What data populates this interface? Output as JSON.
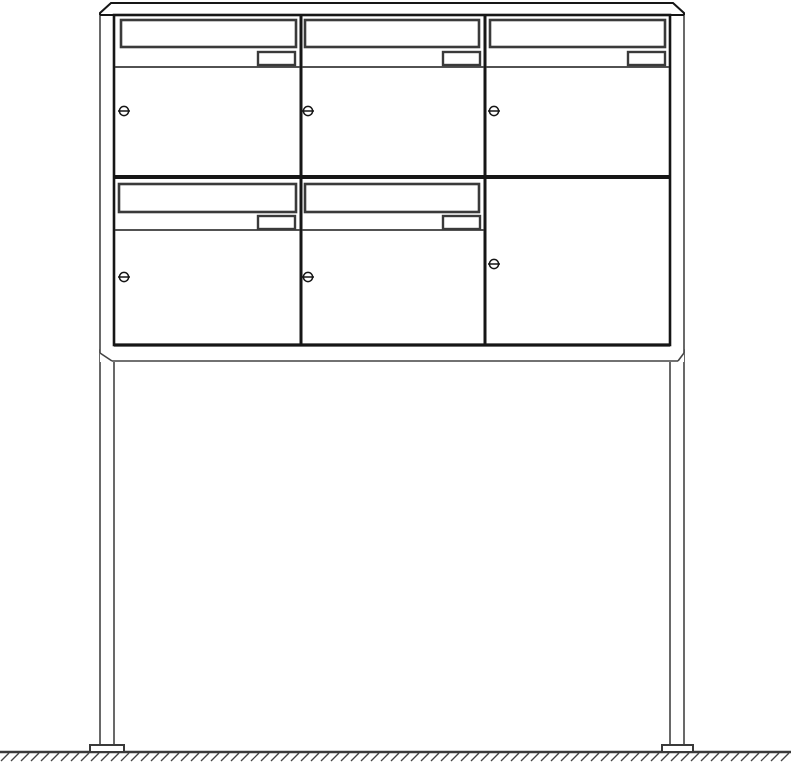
{
  "page": {
    "background": "#ffffff",
    "canvas": {
      "width": 791,
      "height": 762
    }
  },
  "drawing": {
    "kind": "technical-line-drawing",
    "subject": "free-standing-letterbox-unit",
    "colors": {
      "outline": "#161616",
      "detail": "#3a3a3a",
      "thin": "#444444",
      "fill": "#ffffff"
    },
    "unit": {
      "rows": 2,
      "columns": 3,
      "mailboxes_with_slot": 5,
      "plain_locked_doors": 1,
      "legs": 2
    },
    "frame": {
      "roof": {
        "top_y": 3,
        "bottom_y": 15,
        "left_x": 100,
        "right_x": 684,
        "chamfer": 11
      },
      "face": {
        "x": 114,
        "y": 15,
        "w": 556,
        "h": 330
      },
      "column_dividers_x": [
        301,
        485
      ],
      "row_divider_y": 177,
      "base": {
        "line_y": 345,
        "bottom_y": 361,
        "left_x": 100,
        "right_x": 684,
        "chamfer_w": 12,
        "chamfer_h": 8
      },
      "legs": [
        {
          "side": "left",
          "x": 100,
          "w": 14
        },
        {
          "side": "right",
          "x": 670,
          "w": 14
        }
      ],
      "legs_top_y": 350,
      "legs_bottom_y": 746,
      "feet": [
        {
          "side": "left",
          "x": 90,
          "w": 34
        },
        {
          "side": "right",
          "x": 662,
          "w": 31
        }
      ],
      "feet_y": 745,
      "feet_h": 7,
      "ground_y": 752,
      "hatch": {
        "step": 10,
        "dx": 8,
        "y_low": 761,
        "y_high": 753,
        "x_start": 1,
        "x_end": 791
      }
    },
    "compartments": [
      {
        "id": "top-left",
        "row": 0,
        "col": 0,
        "door": {
          "x": 114,
          "y": 15,
          "w": 187,
          "h": 162
        },
        "slot": {
          "x": 121,
          "y": 20,
          "w": 175,
          "h": 27
        },
        "flap_line_y": 67,
        "nameplate": {
          "x": 258,
          "y": 52,
          "w": 37,
          "h": 13
        },
        "lock": {
          "cx": 124,
          "cy": 111
        }
      },
      {
        "id": "top-middle",
        "row": 0,
        "col": 1,
        "door": {
          "x": 301,
          "y": 15,
          "w": 184,
          "h": 162
        },
        "slot": {
          "x": 305,
          "y": 20,
          "w": 174,
          "h": 27
        },
        "flap_line_y": 67,
        "nameplate": {
          "x": 443,
          "y": 52,
          "w": 37,
          "h": 13
        },
        "lock": {
          "cx": 308,
          "cy": 111
        }
      },
      {
        "id": "top-right",
        "row": 0,
        "col": 2,
        "door": {
          "x": 485,
          "y": 15,
          "w": 185,
          "h": 162
        },
        "slot": {
          "x": 490,
          "y": 20,
          "w": 175,
          "h": 27
        },
        "flap_line_y": 67,
        "nameplate": {
          "x": 628,
          "y": 52,
          "w": 37,
          "h": 13
        },
        "lock": {
          "cx": 494,
          "cy": 111
        }
      },
      {
        "id": "bottom-left",
        "row": 1,
        "col": 0,
        "door": {
          "x": 114,
          "y": 177,
          "w": 187,
          "h": 168
        },
        "slot": {
          "x": 119,
          "y": 184,
          "w": 177,
          "h": 28
        },
        "flap_line_y": 230,
        "nameplate": {
          "x": 258,
          "y": 216,
          "w": 37,
          "h": 13
        },
        "lock": {
          "cx": 124,
          "cy": 277
        }
      },
      {
        "id": "bottom-middle",
        "row": 1,
        "col": 1,
        "door": {
          "x": 301,
          "y": 177,
          "w": 184,
          "h": 168
        },
        "slot": {
          "x": 305,
          "y": 184,
          "w": 174,
          "h": 28
        },
        "flap_line_y": 230,
        "nameplate": {
          "x": 443,
          "y": 216,
          "w": 37,
          "h": 13
        },
        "lock": {
          "cx": 308,
          "cy": 277
        }
      },
      {
        "id": "bottom-right",
        "row": 1,
        "col": 2,
        "door": {
          "x": 485,
          "y": 177,
          "w": 185,
          "h": 168
        },
        "slot": null,
        "flap_line_y": null,
        "nameplate": null,
        "lock": {
          "cx": 494,
          "cy": 264
        }
      }
    ]
  }
}
